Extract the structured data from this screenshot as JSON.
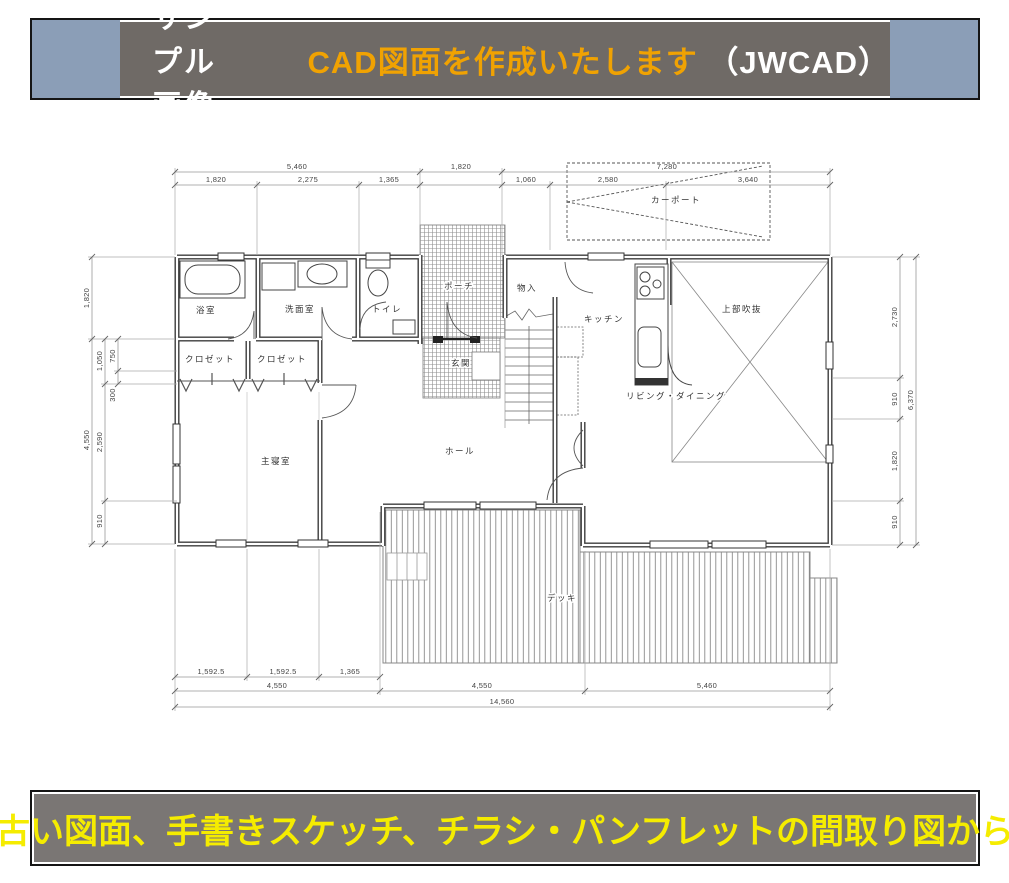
{
  "banner_top": {
    "label": "サンプル画像",
    "title": "CAD図面を作成いたします",
    "suffix": "（JWCAD）",
    "bg": "#6f6a66",
    "cap_color": "#8b9eb7",
    "title_color": "#f0a202",
    "label_color": "#ffffff"
  },
  "banner_bottom": {
    "text": "古い図面、手書きスケッチ、チラシ・パンフレットの間取り図から",
    "bg": "#7a7674",
    "text_color": "#f5ec00"
  },
  "plan": {
    "rooms": {
      "bath": "浴室",
      "wash": "洗面室",
      "toilet": "トイレ",
      "closet1": "クロゼット",
      "closet2": "クロゼット",
      "bedroom": "主寝室",
      "porch": "ポーチ",
      "entry": "玄関",
      "storage": "物入",
      "kitchen": "キッチン",
      "carport": "カーポート",
      "void": "上部吹抜",
      "living": "リビング・ダイニング",
      "hall": "ホール",
      "deck": "デッキ"
    },
    "dims": {
      "top1": [
        "5,460",
        "1,820",
        "7,280"
      ],
      "top2": [
        "1,820",
        "2,275",
        "1,365",
        "1,060",
        "2,580",
        "3,640"
      ],
      "bottom1": [
        "1,592.5",
        "1,592.5",
        "1,365"
      ],
      "bottom2": [
        "4,550",
        "4,550",
        "5,460"
      ],
      "total_width": "14,560",
      "left_outer": [
        "1,820",
        "4,550"
      ],
      "left_inner": [
        "1,050",
        "2,590",
        "910"
      ],
      "left_detail": [
        "750",
        "300"
      ],
      "right_inner": [
        "2,730",
        "910",
        "1,820",
        "910"
      ],
      "total_height": "6,370"
    }
  }
}
